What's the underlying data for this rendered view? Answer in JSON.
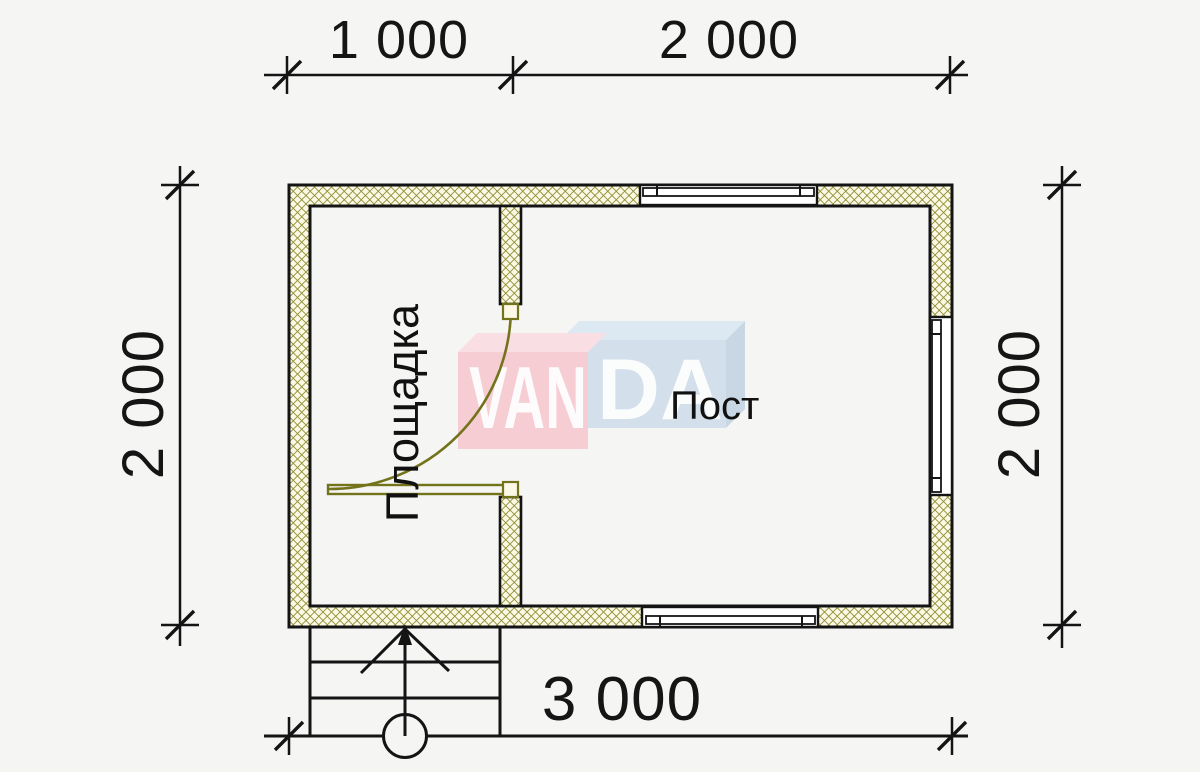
{
  "plan": {
    "type_note": "floor plan drawing",
    "dimension_labels": {
      "top_first": "1 000",
      "top_second": "2 000",
      "left": "2 000",
      "right": "2 000",
      "bottom": "3 000"
    },
    "room_labels": {
      "platform": "Площадка",
      "post": "Пост"
    },
    "watermark": {
      "left_text": "VAN",
      "right_text": "DA"
    },
    "colors": {
      "background": "#f5f5f4",
      "line": "#141414",
      "wall_fill": "#fbf9e6",
      "wall_hatch": "#8e8e33",
      "door": "#73731c",
      "watermark_pink_face": "#f6cdd2",
      "watermark_pink_top": "#f9dfe3",
      "watermark_blue_face": "#d3dfea",
      "watermark_blue_top": "#dde9f2",
      "watermark_blue_side": "#c9d7e4",
      "watermark_text": "#fdfdfd"
    }
  }
}
